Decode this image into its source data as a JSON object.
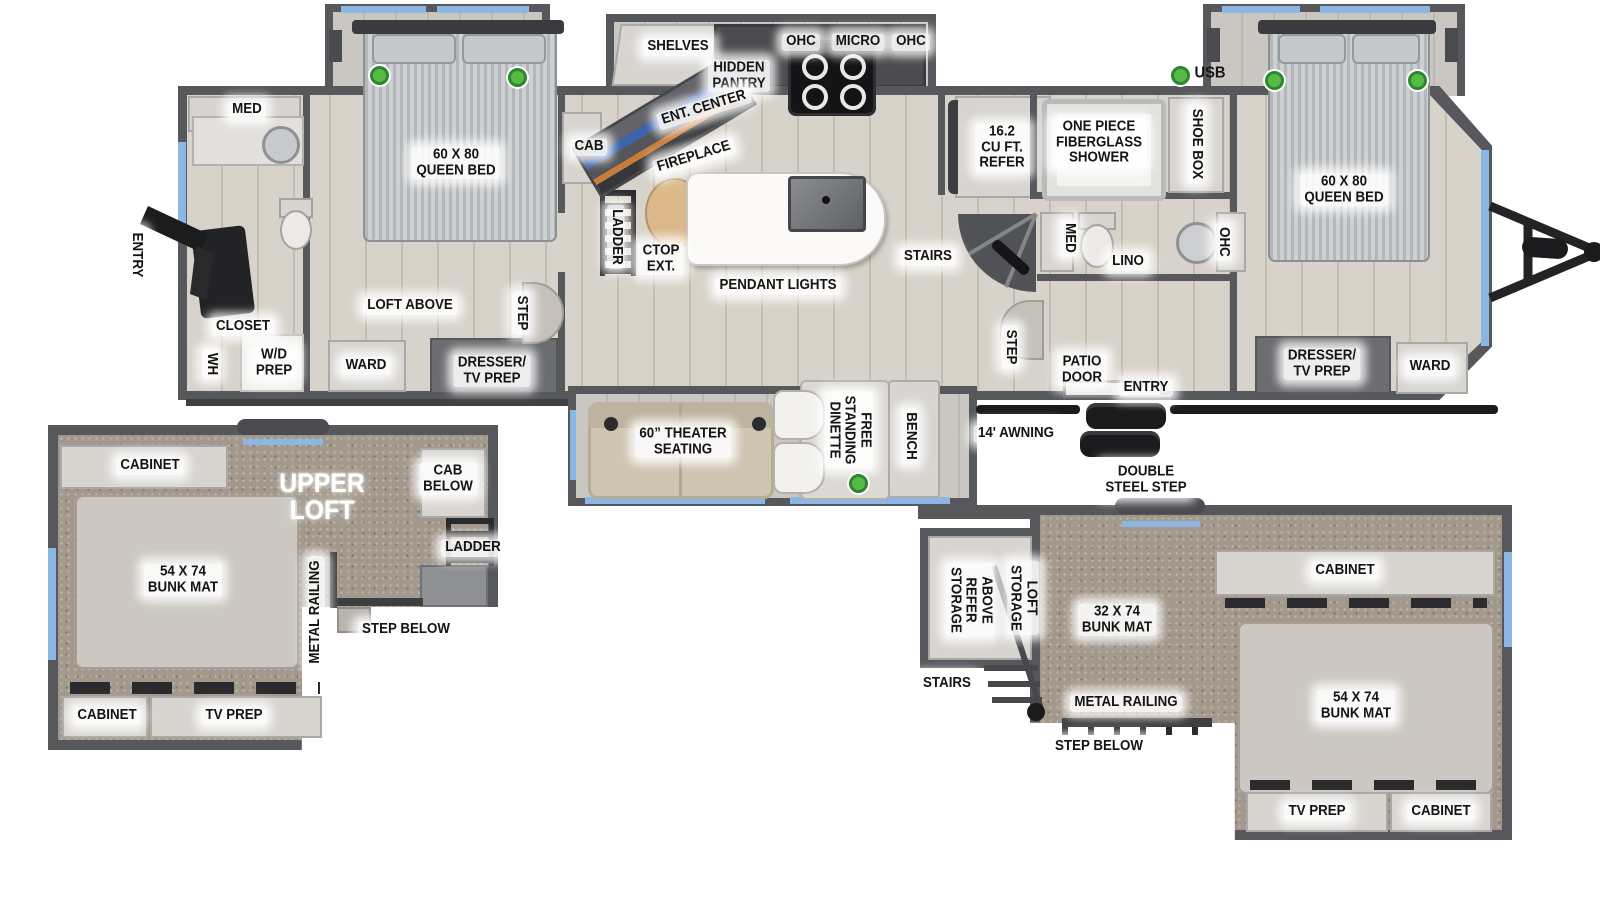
{
  "diagram_type": "RV travel trailer floor plan",
  "colors": {
    "wall": "#57585c",
    "floor": "#d8d3ca",
    "carpet": "#a2988b",
    "window_accent": "#8cb7e4",
    "usb_marker_green": "#56bb46",
    "furniture_light": "#d8d5d0",
    "furniture_dark": "#6c6d71",
    "theater_beige": "#cfc6b2",
    "counter_wood": "#dcb98b"
  },
  "labels": {
    "shelves": "SHELVES",
    "hidden_pantry": "HIDDEN\nPANTRY",
    "ohc_left": "OHC",
    "micro": "MICRO",
    "ohc_right": "OHC",
    "ent_center": "ENT. CENTER",
    "fireplace": "FIREPLACE",
    "cab_living": "CAB",
    "ladder_main": "LADDER",
    "ctop_ext": "CTOP\nEXT.",
    "pendant_lights": "PENDANT LIGHTS",
    "stairs_main": "STAIRS",
    "refer": "16.2\nCU FT.\nREFER",
    "shower": "ONE PIECE\nFIBERGLASS\nSHOWER",
    "shoe_box": "SHOE BOX",
    "usb": "USB",
    "med_mid": "MED",
    "lino": "LINO",
    "ohc_bath": "OHC",
    "queen_bed_right": "60 X 80\nQUEEN BED",
    "step_mid": "STEP",
    "patio_door": "PATIO\nDOOR",
    "entry_mid": "ENTRY",
    "dresser_tv_right": "DRESSER/\nTV PREP",
    "ward_right": "WARD",
    "med_rear": "MED",
    "entry_rear": "ENTRY",
    "closet": "CLOSET",
    "wh": "WH",
    "wd_prep": "W/D\nPREP",
    "queen_bed_left": "60 X 80\nQUEEN BED",
    "loft_above": "LOFT ABOVE",
    "step_left": "STEP",
    "ward_left": "WARD",
    "dresser_tv_left": "DRESSER/\nTV PREP",
    "theater_seating": "60” THEATER\nSEATING",
    "dinette": "FREE\nSTANDING\nDINETTE",
    "bench": "BENCH",
    "awning": "14' AWNING",
    "double_steel_step": "DOUBLE\nSTEEL STEP",
    "ll_cabinet_top": "CABINET",
    "upper_loft": "UPPER\nLOFT",
    "cab_below": "CAB\nBELOW",
    "ll_ladder": "LADDER",
    "ll_bunk54": "54 X 74\nBUNK MAT",
    "ll_metal_railing": "METAL RAILING",
    "ll_step_below": "STEP BELOW",
    "ll_cabinet_bottom": "CABINET",
    "ll_tv_prep": "TV PREP",
    "rl_above_refer_storage": "ABOVE\nREFER\nSTORAGE",
    "rl_loft_storage": "LOFT\nSTORAGE",
    "rl_bunk32": "32 X 74\nBUNK MAT",
    "rl_cabinet_top": "CABINET",
    "rl_stairs": "STAIRS",
    "rl_metal_railing": "METAL RAILING",
    "rl_step_below": "STEP BELOW",
    "rl_bunk54": "54 X 74\nBUNK MAT",
    "rl_tv_prep": "TV PREP",
    "rl_cabinet_bottom": "CABINET"
  }
}
